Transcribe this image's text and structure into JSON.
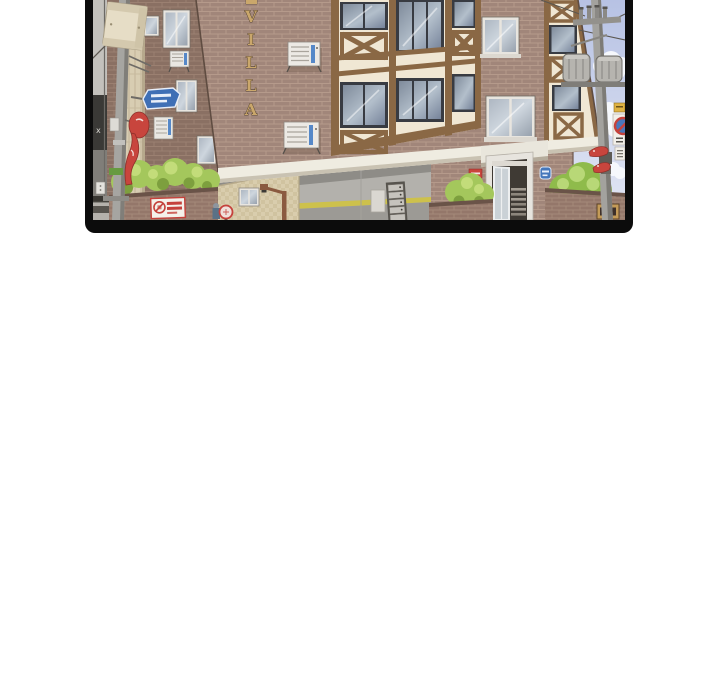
{
  "meta": {
    "title": "Webtoon panel - street corner villa"
  },
  "panel": {
    "kind": "comic-panel",
    "border_color": "#0c0c0c",
    "page_background": "#ffffff"
  },
  "scene": {
    "building_sign": {
      "text": "VILLA",
      "letters": [
        "V",
        "I",
        "L",
        "L",
        "A"
      ]
    },
    "wall_mark": "x",
    "colors": {
      "brick_front": "#a1867a",
      "brick_side": "#8a7063",
      "tudor_cream": "#f0e7d4",
      "tudor_timber": "#8a6845",
      "sky": "#bdc7e6",
      "hedge_green": "#a4c75c",
      "sign_red": "#c5423c",
      "sign_blue": "#4577bb",
      "stripe_yellow": "#cdc14c"
    },
    "icons": {
      "street-name-sign": "blue hexagonal plate, white rim",
      "no-parking-sign": "white plate with red ring pictogram and red text lines",
      "no-stopping-sign": "red ring over blue disc on white plate",
      "restaurant-fish-sign": "red fish silhouette",
      "address-plaque": "small blue oval plate",
      "mailbox-unit": "stacked metal letter boxes",
      "ac-unit": "white outdoor unit with blue stripe",
      "transformer": "grey drum on pole"
    }
  }
}
